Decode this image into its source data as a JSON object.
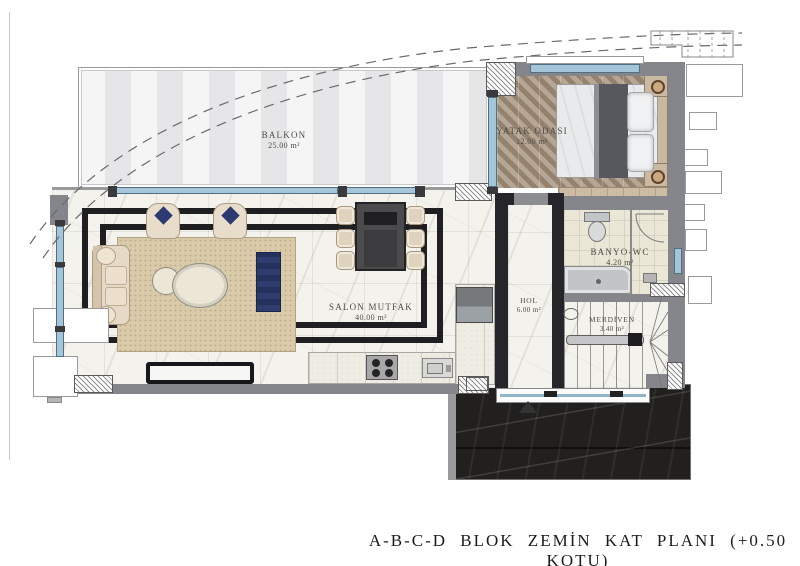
{
  "title": {
    "caption": "A-B-C-D BLOK ZEMİN KAT PLANI (+0.50 KOTU)"
  },
  "rooms": {
    "balkon": {
      "name": "BALKON",
      "area": "25.00 m²"
    },
    "yatak_odasi": {
      "name": "YATAK ODASI",
      "area": "12.00 m²"
    },
    "banyo_wc": {
      "name": "BANYO-WC",
      "area": "4.20 m²"
    },
    "salon_mutfak": {
      "name": "SALON MUTFAK",
      "area": "40.00 m²"
    },
    "hol": {
      "name": "HOL",
      "area": "6.00 m²"
    },
    "merdiven": {
      "name": "MERDİVEN",
      "area": "3.40 m²"
    }
  },
  "colors": {
    "paper": "#ffffff",
    "balcony_floor": "#ededee",
    "marble_floor": "#f4f2ec",
    "dark_inlay": "#1f1f21",
    "wall_gray": "#85868b",
    "wall_dark": "#26262a",
    "glazing_blue": "#a5c6da",
    "wood_floor": "#a3907c",
    "rug_beige": "#d9caa9",
    "navy_furniture": "#2b3a6b",
    "terrace_stone": "#22201f",
    "bathroom_floor": "#ebe7d6",
    "label_ink": "#4b4b44"
  }
}
